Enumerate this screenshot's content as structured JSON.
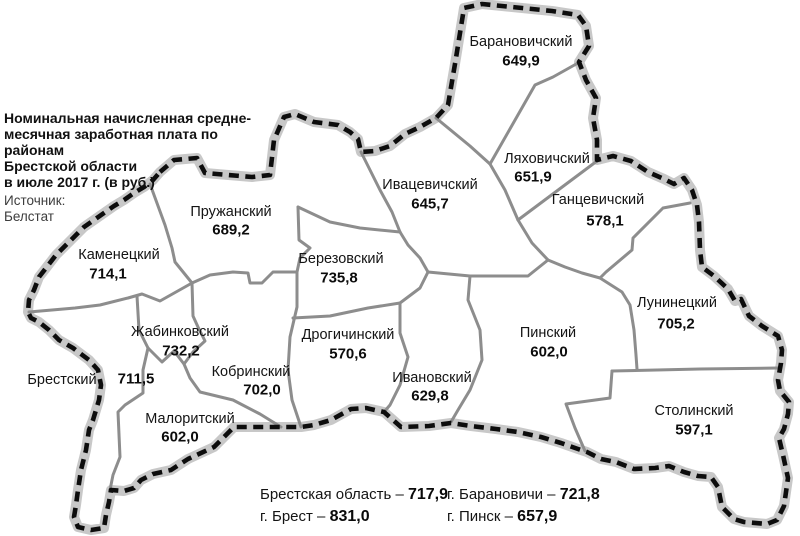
{
  "title": {
    "lines": [
      "Номинальная начисленная средне-",
      "месячная заработная плата по районам",
      "Брестской области",
      "в июле 2017 г. (в руб.)"
    ]
  },
  "source": {
    "lines": [
      "Источник:",
      "Белстат"
    ]
  },
  "region": "Брестская область",
  "districts": [
    {
      "name": "Барановичский",
      "value": "649,9",
      "name_x": 521,
      "name_y": 42,
      "value_x": 521,
      "value_y": 61
    },
    {
      "name": "Ляховичский",
      "value": "651,9",
      "name_x": 547,
      "name_y": 159,
      "value_x": 533,
      "value_y": 177
    },
    {
      "name": "Ганцевичский",
      "value": "578,1",
      "name_x": 598,
      "name_y": 200,
      "value_x": 605,
      "value_y": 221
    },
    {
      "name": "Ивацевичский",
      "value": "645,7",
      "name_x": 430,
      "name_y": 185,
      "value_x": 430,
      "value_y": 204
    },
    {
      "name": "Пружанский",
      "value": "689,2",
      "name_x": 231,
      "name_y": 212,
      "value_x": 231,
      "value_y": 230
    },
    {
      "name": "Каменецкий",
      "value": "714,1",
      "name_x": 119,
      "name_y": 255,
      "value_x": 108,
      "value_y": 274
    },
    {
      "name": "Березовский",
      "value": "735,8",
      "name_x": 341,
      "name_y": 259,
      "value_x": 339,
      "value_y": 278
    },
    {
      "name": "Жабинковский",
      "value": "732,2",
      "name_x": 180,
      "name_y": 332,
      "value_x": 181,
      "value_y": 351
    },
    {
      "name": "Брестский",
      "value": "711,5",
      "name_x": 62,
      "name_y": 380,
      "value_x": 136,
      "value_y": 379
    },
    {
      "name": "Кобринский",
      "value": "702,0",
      "name_x": 251,
      "name_y": 372,
      "value_x": 262,
      "value_y": 390
    },
    {
      "name": "Малоритский",
      "value": "602,0",
      "name_x": 190,
      "name_y": 419,
      "value_x": 180,
      "value_y": 437
    },
    {
      "name": "Дрогичинский",
      "value": "570,6",
      "name_x": 348,
      "name_y": 335,
      "value_x": 348,
      "value_y": 354
    },
    {
      "name": "Ивановский",
      "value": "629,8",
      "name_x": 432,
      "name_y": 378,
      "value_x": 430,
      "value_y": 396
    },
    {
      "name": "Пинский",
      "value": "602,0",
      "name_x": 548,
      "name_y": 333,
      "value_x": 549,
      "value_y": 352
    },
    {
      "name": "Лунинецкий",
      "value": "705,2",
      "name_x": 677,
      "name_y": 303,
      "value_x": 676,
      "value_y": 324
    },
    {
      "name": "Столинский",
      "value": "597,1",
      "name_x": 694,
      "name_y": 411,
      "value_x": 694,
      "value_y": 430
    }
  ],
  "summary": [
    {
      "label": "Брестская область",
      "value": "717,9",
      "x": 260,
      "y": 495
    },
    {
      "label": "г. Брест",
      "value": "831,0",
      "x": 260,
      "y": 517
    },
    {
      "label": "г. Барановичи",
      "value": "721,8",
      "x": 447,
      "y": 495
    },
    {
      "label": "г. Пинск",
      "value": "657,9",
      "x": 447,
      "y": 517
    }
  ],
  "colors": {
    "region_border": "#0d0d0d",
    "region_border_casing": "#c8c8c8",
    "district_boundary": "#8d8d8d",
    "text": "#141414",
    "background": "#ffffff"
  }
}
